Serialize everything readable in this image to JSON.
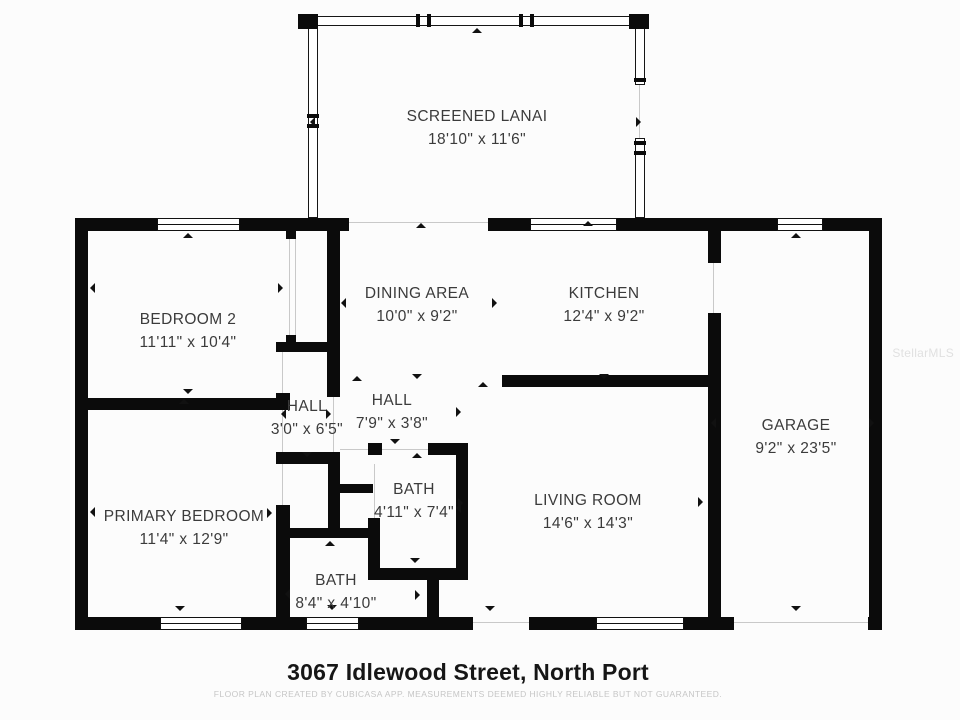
{
  "title": "3067 Idlewood Street, North Port",
  "disclaimer": "FLOOR PLAN CREATED BY CUBICASA APP. MEASUREMENTS DEEMED HIGHLY RELIABLE BUT NOT GUARANTEED.",
  "watermark": "StellarMLS",
  "colors": {
    "wall": "#0b0b0b",
    "background": "#fcfcfc",
    "label_text": "#3b3b3b",
    "disclaimer_text": "#c6c6c6"
  },
  "floorplan": {
    "rooms": [
      {
        "name": "SCREENED LANAI",
        "dims": "18'10\" x 11'6\"",
        "cx": 477,
        "cy": 117
      },
      {
        "name": "BEDROOM 2",
        "dims": "11'11\" x 10'4\"",
        "cx": 188,
        "cy": 320
      },
      {
        "name": "DINING AREA",
        "dims": "10'0\" x 9'2\"",
        "cx": 417,
        "cy": 294
      },
      {
        "name": "KITCHEN",
        "dims": "12'4\" x 9'2\"",
        "cx": 604,
        "cy": 294
      },
      {
        "name": "GARAGE",
        "dims": "9'2\" x 23'5\"",
        "cx": 796,
        "cy": 426
      },
      {
        "name": "HALL",
        "dims": "3'0\" x 6'5\"",
        "cx": 307,
        "cy": 407
      },
      {
        "name": "HALL",
        "dims": "7'9\" x 3'8\"",
        "cx": 392,
        "cy": 401
      },
      {
        "name": "BATH",
        "dims": "4'11\" x 7'4\"",
        "cx": 414,
        "cy": 490
      },
      {
        "name": "PRIMARY BEDROOM",
        "dims": "11'4\" x 12'9\"",
        "cx": 184,
        "cy": 517
      },
      {
        "name": "LIVING ROOM",
        "dims": "14'6\" x 14'3\"",
        "cx": 588,
        "cy": 501
      },
      {
        "name": "BATH",
        "dims": "8'4\" x 4'10\"",
        "cx": 336,
        "cy": 581
      }
    ],
    "walls": [
      [
        75,
        218,
        82,
        13
      ],
      [
        240,
        218,
        109,
        13
      ],
      [
        488,
        218,
        42,
        13
      ],
      [
        617,
        218,
        160,
        13
      ],
      [
        823,
        218,
        59,
        13
      ],
      [
        75,
        617,
        85,
        13
      ],
      [
        242,
        617,
        64,
        13
      ],
      [
        359,
        617,
        114,
        13
      ],
      [
        529,
        617,
        67,
        13
      ],
      [
        684,
        617,
        50,
        13
      ],
      [
        868,
        617,
        14,
        13
      ],
      [
        75,
        218,
        13,
        412
      ],
      [
        869,
        218,
        13,
        412
      ],
      [
        286,
        227,
        10,
        12
      ],
      [
        286,
        335,
        10,
        14
      ],
      [
        327,
        231,
        13,
        121
      ],
      [
        276,
        342,
        64,
        10
      ],
      [
        88,
        398,
        190,
        12
      ],
      [
        276,
        393,
        14,
        17
      ],
      [
        327,
        352,
        13,
        45
      ],
      [
        276,
        452,
        64,
        12
      ],
      [
        276,
        505,
        14,
        112
      ],
      [
        328,
        452,
        12,
        81
      ],
      [
        339,
        484,
        34,
        9
      ],
      [
        281,
        528,
        92,
        10
      ],
      [
        368,
        443,
        14,
        12
      ],
      [
        428,
        443,
        40,
        12
      ],
      [
        456,
        443,
        12,
        137
      ],
      [
        368,
        518,
        12,
        62
      ],
      [
        368,
        568,
        100,
        12
      ],
      [
        427,
        580,
        12,
        37
      ],
      [
        502,
        375,
        206,
        12
      ],
      [
        708,
        231,
        13,
        32
      ],
      [
        708,
        313,
        13,
        304
      ]
    ],
    "screen_walls": [
      [
        306,
        16,
        339,
        10
      ],
      [
        308,
        26,
        10,
        192
      ],
      [
        635,
        26,
        10,
        59
      ],
      [
        635,
        138,
        10,
        80
      ]
    ],
    "posts": [
      [
        298,
        14,
        20,
        15
      ],
      [
        629,
        14,
        20,
        15
      ],
      [
        416,
        14,
        4,
        13
      ],
      [
        427,
        14,
        4,
        13
      ],
      [
        519,
        14,
        4,
        13
      ],
      [
        530,
        14,
        4,
        13
      ],
      [
        307,
        114,
        12,
        4
      ],
      [
        307,
        124,
        12,
        4
      ],
      [
        634,
        78,
        12,
        4
      ],
      [
        634,
        141,
        12,
        4
      ],
      [
        634,
        151,
        12,
        4
      ]
    ],
    "windows": [
      [
        157,
        218,
        83,
        13
      ],
      [
        530,
        218,
        87,
        13
      ],
      [
        777,
        218,
        46,
        13
      ],
      [
        160,
        617,
        82,
        13
      ],
      [
        306,
        617,
        53,
        13
      ],
      [
        596,
        617,
        88,
        13
      ]
    ],
    "openings": [
      [
        349,
        222,
        139,
        1
      ],
      [
        473,
        622,
        56,
        1
      ],
      [
        734,
        622,
        134,
        1
      ],
      [
        713,
        263,
        1,
        50
      ],
      [
        282,
        352,
        1,
        41
      ],
      [
        282,
        410,
        1,
        42
      ],
      [
        282,
        464,
        1,
        41
      ],
      [
        289,
        239,
        1,
        96
      ],
      [
        295,
        239,
        1,
        96
      ],
      [
        333,
        397,
        1,
        55
      ],
      [
        340,
        449,
        28,
        1
      ],
      [
        382,
        449,
        46,
        1
      ],
      [
        374,
        464,
        1,
        54
      ],
      [
        639,
        85,
        1,
        53
      ]
    ],
    "markers": [
      {
        "d": "left",
        "x": 313,
        "y": 122
      },
      {
        "d": "right",
        "x": 641,
        "y": 122
      },
      {
        "d": "up",
        "x": 477,
        "y": 31
      },
      {
        "d": "up",
        "x": 421,
        "y": 226
      },
      {
        "d": "up",
        "x": 588,
        "y": 224
      },
      {
        "d": "up",
        "x": 188,
        "y": 236
      },
      {
        "d": "down",
        "x": 188,
        "y": 394
      },
      {
        "d": "left",
        "x": 93,
        "y": 288
      },
      {
        "d": "right",
        "x": 283,
        "y": 288
      },
      {
        "d": "left",
        "x": 344,
        "y": 303
      },
      {
        "d": "right",
        "x": 497,
        "y": 303
      },
      {
        "d": "down",
        "x": 417,
        "y": 379
      },
      {
        "d": "down",
        "x": 604,
        "y": 379
      },
      {
        "d": "up",
        "x": 796,
        "y": 236
      },
      {
        "d": "left",
        "x": 714,
        "y": 423
      },
      {
        "d": "right",
        "x": 874,
        "y": 423
      },
      {
        "d": "down",
        "x": 796,
        "y": 611
      },
      {
        "d": "left",
        "x": 284,
        "y": 414
      },
      {
        "d": "right",
        "x": 331,
        "y": 414
      },
      {
        "d": "down",
        "x": 307,
        "y": 457
      },
      {
        "d": "up",
        "x": 357,
        "y": 379
      },
      {
        "d": "down",
        "x": 395,
        "y": 444
      },
      {
        "d": "right",
        "x": 461,
        "y": 412
      },
      {
        "d": "up",
        "x": 417,
        "y": 456
      },
      {
        "d": "right",
        "x": 463,
        "y": 503
      },
      {
        "d": "down",
        "x": 415,
        "y": 563
      },
      {
        "d": "up",
        "x": 184,
        "y": 402
      },
      {
        "d": "down",
        "x": 180,
        "y": 611
      },
      {
        "d": "left",
        "x": 93,
        "y": 512
      },
      {
        "d": "right",
        "x": 272,
        "y": 513
      },
      {
        "d": "up",
        "x": 483,
        "y": 385
      },
      {
        "d": "left",
        "x": 459,
        "y": 508
      },
      {
        "d": "right",
        "x": 703,
        "y": 502
      },
      {
        "d": "down",
        "x": 490,
        "y": 611
      },
      {
        "d": "up",
        "x": 330,
        "y": 544
      },
      {
        "d": "left",
        "x": 288,
        "y": 594
      },
      {
        "d": "right",
        "x": 420,
        "y": 595
      },
      {
        "d": "down",
        "x": 332,
        "y": 610
      }
    ]
  }
}
